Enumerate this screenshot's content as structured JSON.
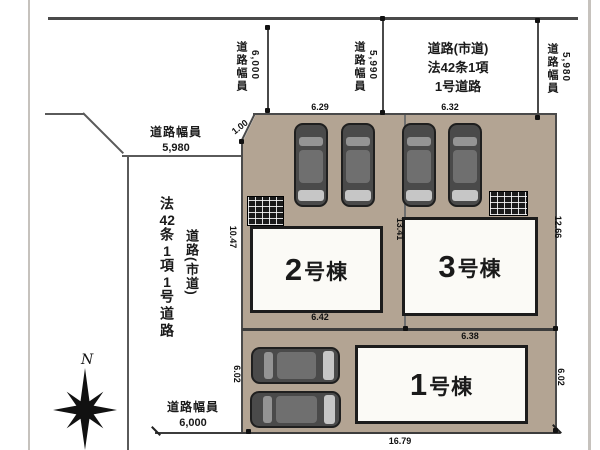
{
  "roads": {
    "top": {
      "name_lines": [
        "道路(市道)",
        "法42条1項",
        "1号道路"
      ],
      "width_label_1": {
        "kanji": "道路幅員",
        "value": "6,000"
      },
      "width_label_2": {
        "kanji": "道路幅員",
        "value": "5,990"
      },
      "width_label_3": {
        "kanji": "道路幅員",
        "value": "5,980"
      },
      "corner_label": {
        "kanji": "道路幅員",
        "value": "5,980"
      }
    },
    "left": {
      "name_parts": [
        "法",
        "42",
        "条",
        "1",
        "項",
        "1",
        "号道路"
      ],
      "name_sub": "道路(市道)",
      "width_label": {
        "kanji": "道路幅員",
        "value": "6,000"
      }
    }
  },
  "lots": {
    "buildings": [
      {
        "num": "1",
        "suffix": "号棟"
      },
      {
        "num": "2",
        "suffix": "号棟"
      },
      {
        "num": "3",
        "suffix": "号棟"
      }
    ]
  },
  "dimensions": {
    "top_w_lot2": "6.29",
    "top_w_lot3": "6.32",
    "corner_cut": "1.00",
    "west_d_lot2": "10.47",
    "mid_boundary": "13.41",
    "east_d_lot3": "12.66",
    "lot2_south": "6.42",
    "lot1_north": "6.38",
    "lot1_west": "6.02",
    "lot1_east": "6.02",
    "south_frontage": "16.79"
  },
  "compass": {
    "label": "N"
  },
  "colors": {
    "lot_fill": "#b3a493",
    "building_fill": "#fbfaf6",
    "car_body": "#4a4a4a",
    "line_dark": "#4a4a4a"
  }
}
